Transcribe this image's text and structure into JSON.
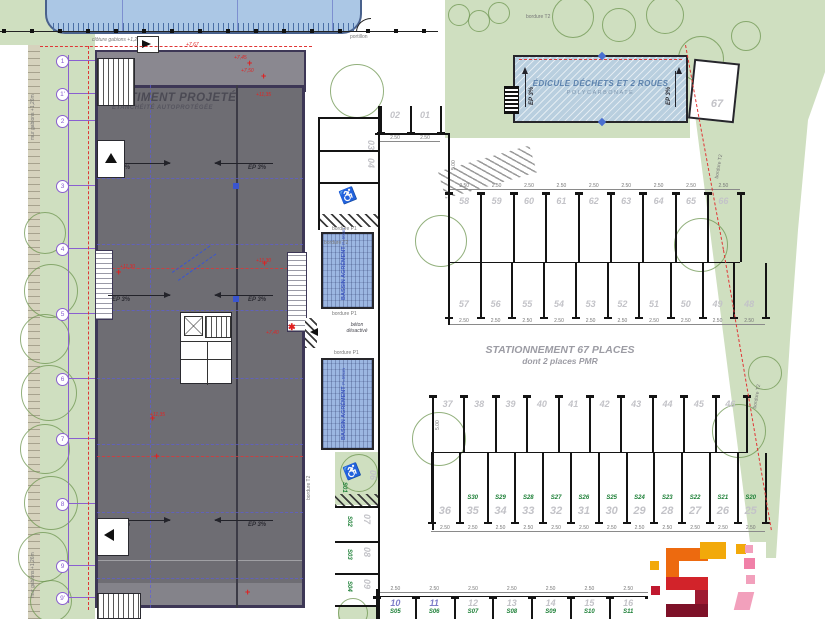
{
  "plan": {
    "building": {
      "title": "BÂTIMENT PROJETÉ",
      "subtitle": "ÉTANCHÉITÉ AUTOPROTÉGÉE",
      "slope": "EP 3%",
      "elevations": {
        "e1": "+7,45",
        "e2": "+7,50",
        "e3": "+7,67",
        "e4": "+11,35",
        "e5": "+11,30",
        "e6": "+7,40"
      }
    },
    "edicule": {
      "title": "ÉDICULE DÉCHETS ET 2 ROUES",
      "subtitle": "POLYCARBONATE",
      "slope": "EP 3%"
    },
    "parking": {
      "caption_line1": "STATIONNEMENT 67 PLACES",
      "caption_line2": "dont 2 places PMR",
      "row_top": [
        "58",
        "59",
        "60",
        "61",
        "62",
        "63",
        "64",
        "65",
        "66"
      ],
      "row_second": [
        "57",
        "56",
        "55",
        "54",
        "53",
        "52",
        "51",
        "50",
        "49",
        "48"
      ],
      "row_third": [
        "37",
        "38",
        "39",
        "40",
        "41",
        "42",
        "43",
        "44",
        "45",
        "46"
      ],
      "row_fourth": {
        "numbers": [
          "36",
          "35",
          "34",
          "33",
          "32",
          "31",
          "30",
          "29",
          "28",
          "27",
          "26",
          "25"
        ],
        "labels": [
          "",
          "S30",
          "S29",
          "S28",
          "S27",
          "S26",
          "S25",
          "S24",
          "S23",
          "S22",
          "S21",
          "S20"
        ]
      },
      "row_bottom": {
        "numbers": [
          "10",
          "11",
          "12",
          "13",
          "14",
          "15",
          "16"
        ],
        "labels": [
          "S05",
          "S06",
          "S07",
          "S08",
          "S09",
          "S10",
          "S11"
        ],
        "pmr_highlight": [
          "10",
          "11"
        ]
      },
      "spaces_top": [
        "02",
        "01"
      ],
      "side_top": [
        "03",
        "04"
      ],
      "side_bottom": {
        "numbers": [
          "07",
          "08",
          "09"
        ],
        "labels": [
          "S02",
          "S03",
          "S04"
        ]
      },
      "pmr_side": {
        "lower_label": "S01",
        "lower_number": "06"
      },
      "space_67": "67",
      "stall_dim": "2.50",
      "aisle_dim": "5.00"
    },
    "bassin": {
      "label": "BASSIN AGRÉMENT",
      "depth": "P=50cm"
    },
    "annotations": {
      "beton_line1": "béton",
      "beton_line2": "désactivé",
      "bordure_t2": "bordure T2",
      "bordure_p1": "bordure P1",
      "portillon": "portillon",
      "cloture": "clôture gabions +1,26m",
      "mur": "mur gabions +1,26m"
    },
    "grid_markers": [
      "1",
      "1'",
      "2",
      "3",
      "4",
      "5",
      "6",
      "7",
      "8",
      "9",
      "9'"
    ]
  },
  "colors": {
    "landscape_green": "#cfdfc0",
    "building_gray": "#6e6d73",
    "pool_blue": "#abc7e5",
    "bassin_blue": "#9cb7e2",
    "boundary_red": "#e03535",
    "grid_purple": "#8a5fd0",
    "stall_number_gray": "#c3c3c8",
    "stall_label_green": "#1e8038",
    "logo_orange": "#ED6A0F",
    "logo_yellow": "#F2A90A",
    "logo_red": "#D2232A",
    "logo_maroon": "#7E1128",
    "logo_pink": "#F2A0BC"
  }
}
